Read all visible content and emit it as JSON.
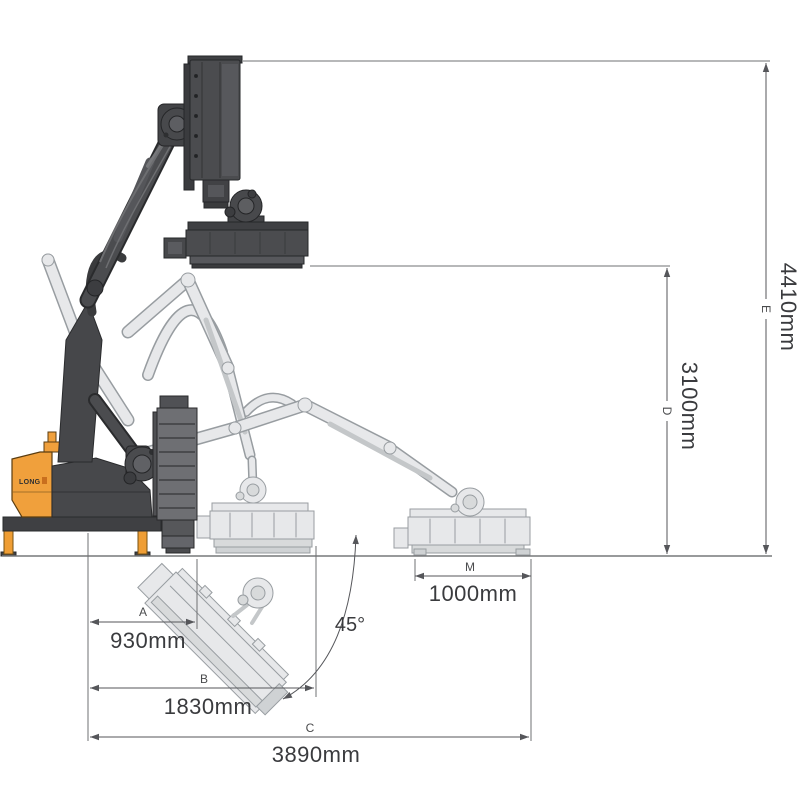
{
  "diagram": {
    "type": "technical-dimension-diagram",
    "subject": "articulated boom flail mower working positions",
    "logo": "LONG",
    "angle": "45°",
    "dims": {
      "A": {
        "letter": "A",
        "value": "930mm"
      },
      "B": {
        "letter": "B",
        "value": "1830mm"
      },
      "C": {
        "letter": "C",
        "value": "3890mm"
      },
      "D": {
        "letter": "D",
        "value": "3100mm"
      },
      "E": {
        "letter": "E",
        "value": "4410mm"
      },
      "M": {
        "letter": "M",
        "value": "1000mm"
      }
    },
    "colors": {
      "background": "#ffffff",
      "accent_orange": "#f0a03c",
      "dark_body": "#4b4c4f",
      "ghost_fill": "#e7e8ea",
      "ghost_stroke": "#989da1",
      "dim_line": "#55565a",
      "text": "#3a3b3e"
    }
  }
}
